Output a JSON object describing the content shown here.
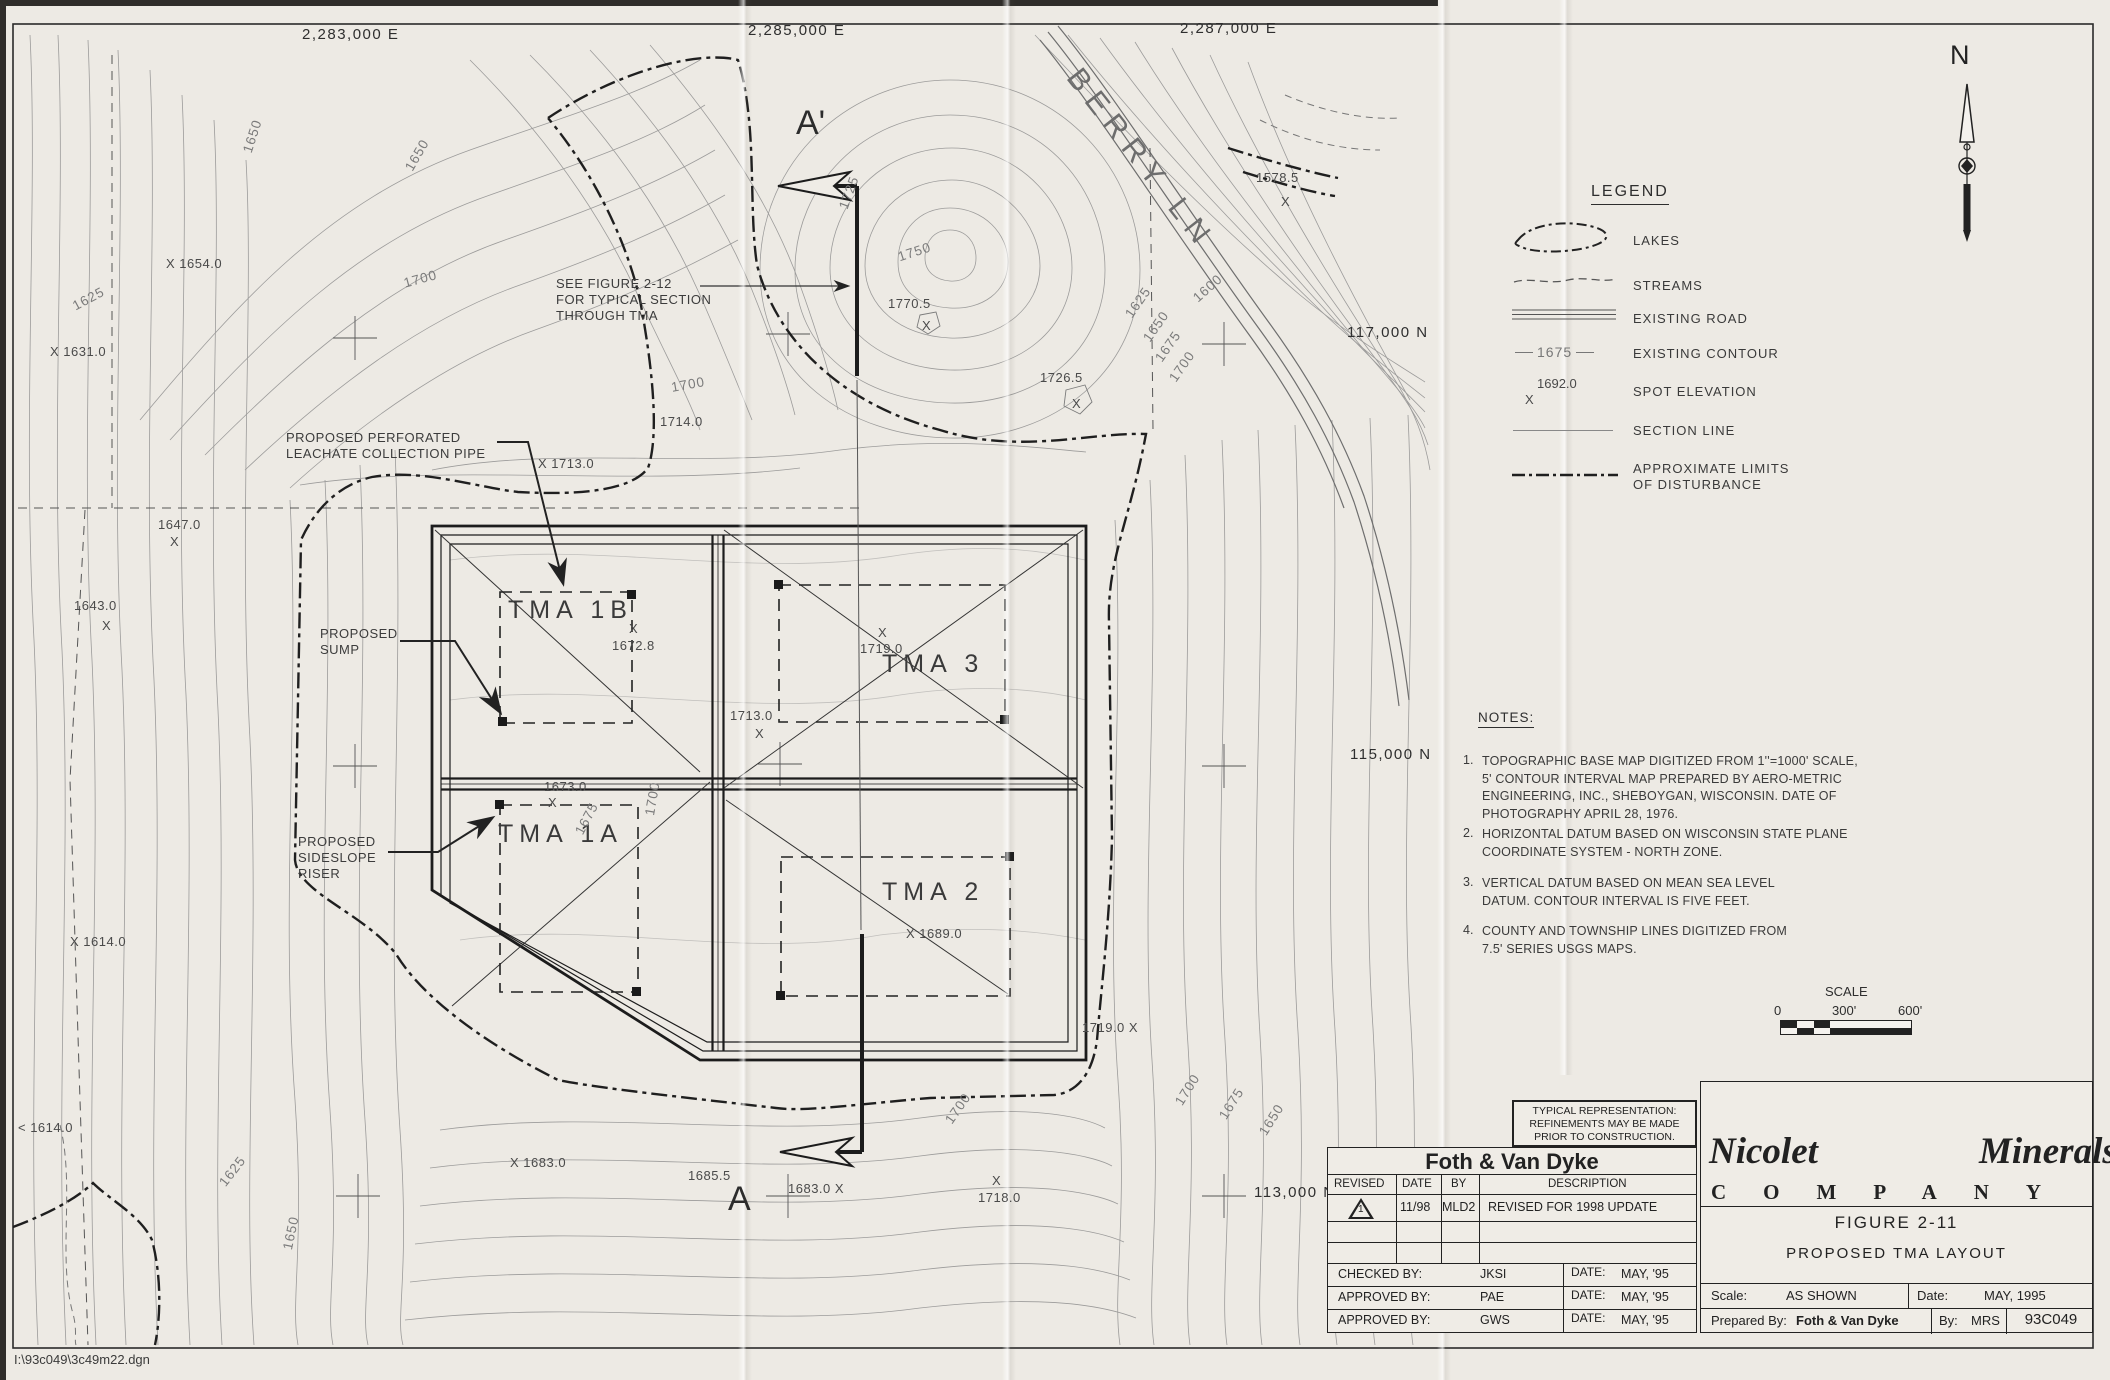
{
  "sheet": {
    "eastings": [
      "2,283,000 E",
      "2,285,000 E",
      "2,287,000 E"
    ],
    "northings": [
      "117,000 N",
      "115,000 N",
      "113,000 N"
    ],
    "north_label": "N",
    "file_path": "I:\\93c049\\3c49m22.dgn"
  },
  "map": {
    "road_label": "BERRY LN",
    "section_top": "A'",
    "section_bottom": "A",
    "see_figure": "SEE FIGURE 2-12\nFOR TYPICAL SECTION\nTHROUGH TMA",
    "callout_leachate": "PROPOSED PERFORATED\nLEACHATE COLLECTION PIPE",
    "callout_sump": "PROPOSED\nSUMP",
    "callout_riser": "PROPOSED\nSIDESLOPE\nRISER",
    "tma": [
      "TMA 1B",
      "TMA 3",
      "TMA 1A",
      "TMA 2"
    ],
    "spot_elevations": [
      {
        "text": "X 1654.0",
        "x": 166,
        "y": 256
      },
      {
        "text": "X 1631.0",
        "x": 50,
        "y": 344
      },
      {
        "text": "1647.0",
        "x": 158,
        "y": 517
      },
      {
        "text": "X",
        "x": 170,
        "y": 534
      },
      {
        "text": "1643.0",
        "x": 74,
        "y": 598
      },
      {
        "text": "X",
        "x": 102,
        "y": 618
      },
      {
        "text": "X 1614.0",
        "x": 70,
        "y": 934
      },
      {
        "text": "< 1614.0",
        "x": 18,
        "y": 1120
      },
      {
        "text": "X 1713.0",
        "x": 538,
        "y": 456
      },
      {
        "text": "1714.0",
        "x": 660,
        "y": 414
      },
      {
        "text": "1770.5",
        "x": 888,
        "y": 296
      },
      {
        "text": "X",
        "x": 922,
        "y": 318
      },
      {
        "text": "1726.5",
        "x": 1040,
        "y": 370
      },
      {
        "text": "X",
        "x": 1072,
        "y": 396
      },
      {
        "text": "1578.5",
        "x": 1256,
        "y": 170
      },
      {
        "text": "X",
        "x": 1281,
        "y": 194
      },
      {
        "text": "X",
        "x": 629,
        "y": 621
      },
      {
        "text": "1672.8",
        "x": 612,
        "y": 638
      },
      {
        "text": "X",
        "x": 878,
        "y": 625
      },
      {
        "text": "1719.0",
        "x": 860,
        "y": 641
      },
      {
        "text": "1713.0",
        "x": 730,
        "y": 708
      },
      {
        "text": "X",
        "x": 755,
        "y": 726
      },
      {
        "text": "1673.0",
        "x": 544,
        "y": 779
      },
      {
        "text": "X",
        "x": 548,
        "y": 795
      },
      {
        "text": "X 1689.0",
        "x": 906,
        "y": 926
      },
      {
        "text": "X 1683.0",
        "x": 510,
        "y": 1155
      },
      {
        "text": "1685.5",
        "x": 688,
        "y": 1168
      },
      {
        "text": "1683.0 X",
        "x": 788,
        "y": 1181
      },
      {
        "text": "X",
        "x": 992,
        "y": 1173
      },
      {
        "text": "1718.0",
        "x": 978,
        "y": 1190
      },
      {
        "text": "1719.0 X",
        "x": 1082,
        "y": 1020
      }
    ],
    "contour_labels": [
      {
        "text": "1650",
        "x": 240,
        "y": 150,
        "rot": -72
      },
      {
        "text": "1650",
        "x": 402,
        "y": 166,
        "rot": -60
      },
      {
        "text": "1625",
        "x": 70,
        "y": 300,
        "rot": -28
      },
      {
        "text": "1700",
        "x": 402,
        "y": 276,
        "rot": -15
      },
      {
        "text": "1700",
        "x": 670,
        "y": 380,
        "rot": -10
      },
      {
        "text": "1725",
        "x": 836,
        "y": 206,
        "rot": -70
      },
      {
        "text": "1750",
        "x": 896,
        "y": 250,
        "rot": -18
      },
      {
        "text": "1600",
        "x": 1190,
        "y": 294,
        "rot": -42
      },
      {
        "text": "1625",
        "x": 1122,
        "y": 312,
        "rot": -55
      },
      {
        "text": "1650",
        "x": 1140,
        "y": 336,
        "rot": -55
      },
      {
        "text": "1675",
        "x": 1152,
        "y": 356,
        "rot": -55
      },
      {
        "text": "1700",
        "x": 1166,
        "y": 376,
        "rot": -55
      },
      {
        "text": "1675",
        "x": 572,
        "y": 830,
        "rot": -62
      },
      {
        "text": "1700",
        "x": 642,
        "y": 814,
        "rot": -80
      },
      {
        "text": "1700",
        "x": 942,
        "y": 1118,
        "rot": -55
      },
      {
        "text": "1700",
        "x": 1172,
        "y": 1100,
        "rot": -58
      },
      {
        "text": "1675",
        "x": 1216,
        "y": 1114,
        "rot": -58
      },
      {
        "text": "1650",
        "x": 1256,
        "y": 1130,
        "rot": -58
      },
      {
        "text": "1625",
        "x": 216,
        "y": 1180,
        "rot": -52
      },
      {
        "text": "1650",
        "x": 280,
        "y": 1248,
        "rot": -78
      }
    ]
  },
  "legend": {
    "title": "LEGEND",
    "items": [
      {
        "label": "LAKES"
      },
      {
        "label": "STREAMS"
      },
      {
        "label": "EXISTING ROAD"
      },
      {
        "label": "EXISTING CONTOUR",
        "sample": "1675"
      },
      {
        "label": "SPOT ELEVATION",
        "sample": "1692.0",
        "marker": "X"
      },
      {
        "label": "SECTION LINE"
      },
      {
        "label": "APPROXIMATE LIMITS\nOF DISTURBANCE"
      }
    ]
  },
  "notes": {
    "title": "NOTES:",
    "items": [
      {
        "num": "1.",
        "text": "TOPOGRAPHIC BASE MAP DIGITIZED FROM 1''=1000' SCALE,\n5' CONTOUR INTERVAL MAP PREPARED BY AERO-METRIC\nENGINEERING, INC., SHEBOYGAN, WISCONSIN. DATE OF\nPHOTOGRAPHY APRIL 28, 1976."
      },
      {
        "num": "2.",
        "text": "HORIZONTAL DATUM BASED ON WISCONSIN STATE PLANE\nCOORDINATE SYSTEM - NORTH ZONE."
      },
      {
        "num": "3.",
        "text": "VERTICAL DATUM BASED ON MEAN SEA LEVEL\nDATUM. CONTOUR INTERVAL IS FIVE FEET."
      },
      {
        "num": "4.",
        "text": "COUNTY AND TOWNSHIP LINES DIGITIZED FROM\n7.5' SERIES USGS MAPS."
      }
    ]
  },
  "scale_bar": {
    "title": "SCALE",
    "ticks": [
      "0",
      "300'",
      "600'"
    ]
  },
  "title_block": {
    "note": "TYPICAL REPRESENTATION:\nREFINEMENTS MAY BE MADE\nPRIOR TO CONSTRUCTION.",
    "firm": "Foth & Van Dyke",
    "rev_headers": [
      "REVISED",
      "DATE",
      "BY",
      "DESCRIPTION"
    ],
    "rev_row": {
      "symbol": "1",
      "date": "11/98",
      "by": "MLD2",
      "description": "REVISED FOR 1998 UPDATE"
    },
    "approvals": [
      {
        "label": "CHECKED BY:",
        "value": "JKSI",
        "date_label": "DATE:",
        "date": "MAY, '95"
      },
      {
        "label": "APPROVED BY:",
        "value": "PAE",
        "date_label": "DATE:",
        "date": "MAY, '95"
      },
      {
        "label": "APPROVED BY:",
        "value": "GWS",
        "date_label": "DATE:",
        "date": "MAY, '95"
      }
    ],
    "company_left": "Nicolet",
    "company_right": "Minerals",
    "company_word": "COMPANY",
    "logo_top": "Mining for the Future",
    "logo_bottom": "Commitment",
    "figure": "FIGURE 2-11",
    "drawing_title": "PROPOSED TMA LAYOUT",
    "scale_label": "Scale:",
    "scale_value": "AS SHOWN",
    "date_label": "Date:",
    "date_value": "MAY, 1995",
    "prepared_label": "Prepared By:",
    "prepared_value": "Foth & Van Dyke",
    "by_label": "By:",
    "by_value": "MRS",
    "number": "93C049"
  }
}
